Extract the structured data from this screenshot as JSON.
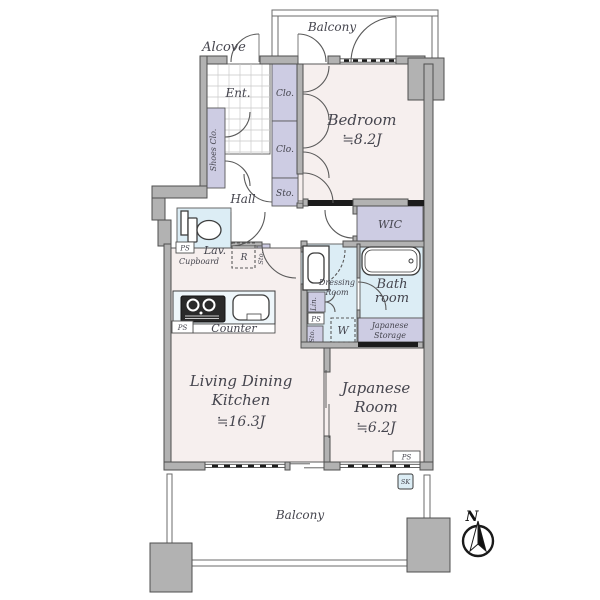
{
  "colors": {
    "floor": "#f6efee",
    "wet_area": "#dcedf5",
    "closet": "#cdcce3",
    "wall": "#b2b2b2",
    "outline": "#4f4f4f",
    "hatch": "#1c1c1c",
    "text": "#45454e"
  },
  "labels": {
    "balcony": "Balcony",
    "alcove": "Alcove",
    "ent": "Ent.",
    "shoes_clo": "Shoes Clo.",
    "clo": "Clo.",
    "sto": "Sto.",
    "hall": "Hall",
    "lav": "Lav.",
    "cupboard": "Cupboard",
    "fridge": "R",
    "wic": "WIC",
    "dressing1": "Dressing",
    "dressing2": "Room",
    "bath1": "Bath",
    "bath2": "room",
    "lin": "Lin.",
    "washer": "W",
    "jstorage1": "Japanese",
    "jstorage2": "Storage",
    "counter": "Counter",
    "ps": "PS",
    "sk": "SK"
  },
  "rooms": {
    "bedroom": {
      "name": "Bedroom",
      "size": "≒8.2J"
    },
    "ldk": {
      "name1": "Living Dining",
      "name2": "Kitchen",
      "size": "≒16.3J"
    },
    "japanese": {
      "name1": "Japanese",
      "name2": "Room",
      "size": "≒6.2J"
    }
  },
  "compass": {
    "north": "N"
  }
}
